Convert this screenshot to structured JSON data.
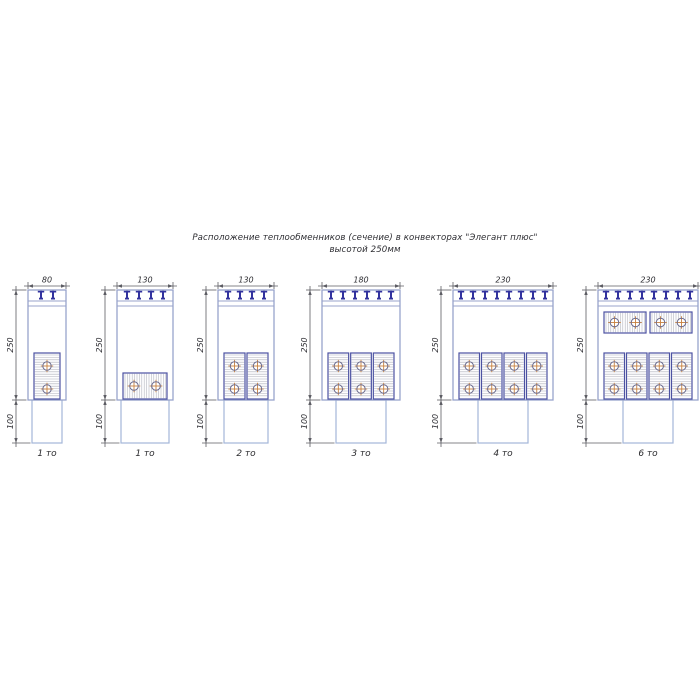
{
  "title": {
    "line1": "Расположение теплообменников (сечение) в конвекторах \"Элегант плюс\"",
    "line2": "высотой 250мм"
  },
  "colors": {
    "body_outline": "#98a3cb",
    "duct_outline": "#a3b6d8",
    "block_outline": "#4c52a2",
    "clip": "#32329e",
    "hatch": "#aeb1bb",
    "dim_line": "#5c5c63",
    "dim_text": "#2e2e33",
    "circle_outline": "#6b6b8e",
    "circle_cross": "#c8803f",
    "caption_text": "#2b2b2e"
  },
  "diagrams": [
    {
      "id": "conv-80-1to",
      "width_label": "80",
      "height_label": "250",
      "lower_height_label": "100",
      "caption": "1 то",
      "clip_count": 2,
      "heat_exchanger_rows": [
        {
          "orientation": "vertical",
          "count": 1,
          "position": "bottom",
          "tubes_per_block": 2
        }
      ]
    },
    {
      "id": "conv-130-1to",
      "width_label": "130",
      "height_label": "250",
      "lower_height_label": "100",
      "caption": "1 то",
      "clip_count": 4,
      "heat_exchanger_rows": [
        {
          "orientation": "horizontal",
          "count": 1,
          "position": "bottom",
          "tubes_per_block": 2
        }
      ]
    },
    {
      "id": "conv-130-2to",
      "width_label": "130",
      "height_label": "250",
      "lower_height_label": "100",
      "caption": "2 то",
      "clip_count": 4,
      "heat_exchanger_rows": [
        {
          "orientation": "vertical",
          "count": 2,
          "position": "bottom",
          "tubes_per_block": 2
        }
      ]
    },
    {
      "id": "conv-180-3to",
      "width_label": "180",
      "height_label": "250",
      "lower_height_label": "100",
      "caption": "3 то",
      "clip_count": 6,
      "heat_exchanger_rows": [
        {
          "orientation": "vertical",
          "count": 3,
          "position": "bottom",
          "tubes_per_block": 2
        }
      ]
    },
    {
      "id": "conv-230-4to",
      "width_label": "230",
      "height_label": "250",
      "lower_height_label": "100",
      "caption": "4 то",
      "clip_count": 8,
      "heat_exchanger_rows": [
        {
          "orientation": "vertical",
          "count": 4,
          "position": "bottom",
          "tubes_per_block": 2
        }
      ]
    },
    {
      "id": "conv-230-6to",
      "width_label": "230",
      "height_label": "250",
      "lower_height_label": "100",
      "caption": "6 то",
      "clip_count": 8,
      "heat_exchanger_rows": [
        {
          "orientation": "horizontal",
          "count": 2,
          "position": "top",
          "tubes_per_block": 2
        },
        {
          "orientation": "vertical",
          "count": 4,
          "position": "bottom",
          "tubes_per_block": 2
        }
      ]
    }
  ]
}
